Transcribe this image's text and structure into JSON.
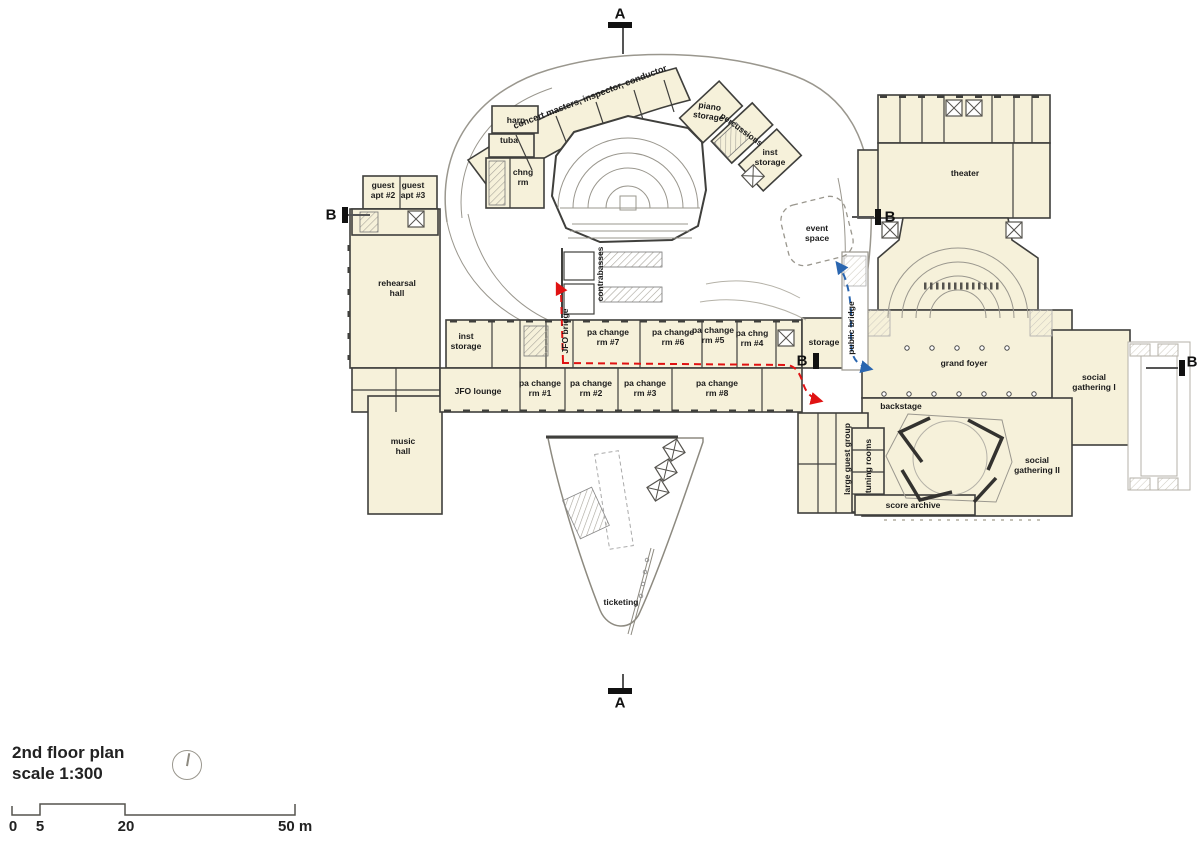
{
  "plan": {
    "legend": {
      "title_line1": "2nd floor plan",
      "title_line2": "scale 1:300"
    },
    "scale": {
      "m0": "0",
      "m5": "5",
      "m20": "20",
      "m50": "50 m"
    },
    "markers": {
      "a": "A",
      "b": "B"
    },
    "colors": {
      "room_fill": "#f6f1da",
      "wall": "#3f3f3c",
      "light_line": "#9a978e",
      "route_red": "#e01212",
      "route_blue": "#2a66b0"
    },
    "rooms": {
      "concert_masters": {
        "label": "concert masters, inspector, conductor"
      },
      "harp": {
        "label": "harp"
      },
      "tuba": {
        "label": "tuba"
      },
      "chng_rm": {
        "label": "chng\nrm"
      },
      "piano_storage": {
        "label": "piano\nstorage"
      },
      "percussions": {
        "label": "percussions"
      },
      "inst_storage_ne": {
        "label": "inst\nstorage"
      },
      "event_space": {
        "label": "event\nspace"
      },
      "guest_apt2": {
        "label": "guest\napt #2"
      },
      "guest_apt3": {
        "label": "guest\napt #3"
      },
      "rehearsal_hall": {
        "label": "rehearsal\nhall"
      },
      "inst_storage_w": {
        "label": "inst\nstorage"
      },
      "jfo_bridge": {
        "label": "JFO bridge"
      },
      "pa7": {
        "label": "pa change\nrm #7"
      },
      "pa6": {
        "label": "pa change\nrm #6"
      },
      "pa5": {
        "label": "pa change\nrm #5"
      },
      "pa4": {
        "label": "pa chng\nrm #4"
      },
      "storage": {
        "label": "storage"
      },
      "public_bridge": {
        "label": "public bridge"
      },
      "theater": {
        "label": "theater"
      },
      "grand_foyer": {
        "label": "grand foyer"
      },
      "social_gathering_1": {
        "label": "social\ngathering I"
      },
      "backstage": {
        "label": "backstage"
      },
      "large_guest_group": {
        "label": "large guest group"
      },
      "tuning_rooms": {
        "label": "tuning rooms"
      },
      "social_gathering_2": {
        "label": "social\ngathering II"
      },
      "score_archive": {
        "label": "score archive"
      },
      "contrabasses": {
        "label": "contrabasses"
      },
      "ticketing": {
        "label": "ticketing"
      },
      "jfo_lounge": {
        "label": "JFO lounge"
      },
      "pa1": {
        "label": "pa change\nrm #1"
      },
      "pa2": {
        "label": "pa change\nrm #2"
      },
      "pa3": {
        "label": "pa change\nrm #3"
      },
      "pa8": {
        "label": "pa change\nrm #8"
      },
      "music_hall": {
        "label": "music\nhall"
      }
    }
  }
}
